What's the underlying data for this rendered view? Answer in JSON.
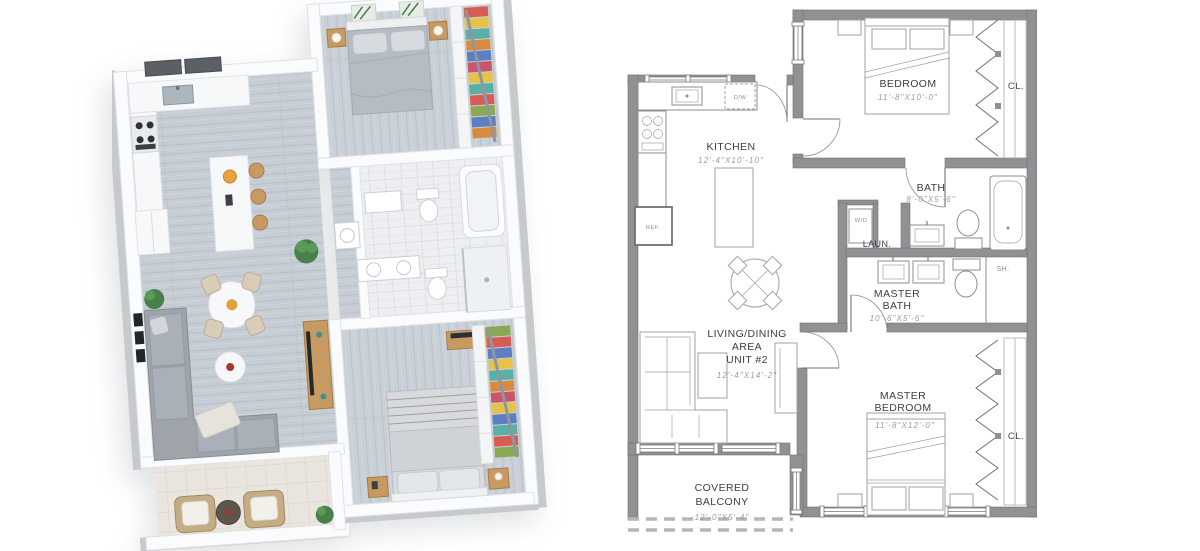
{
  "plan2d": {
    "kitchen": {
      "name": "KITCHEN",
      "dims": "12'-4\"X10'-10\""
    },
    "bedroom": {
      "name": "BEDROOM",
      "dims": "11'-8\"X10'-0\""
    },
    "closet_top": {
      "name": "CL."
    },
    "bath": {
      "name": "BATH",
      "dims": "8'-0\"X5'-6\""
    },
    "laundry": {
      "name": "LAUN.",
      "appliance": "W/D"
    },
    "master_bath": {
      "line1": "MASTER",
      "line2": "BATH",
      "dims": "10'-6\"X5'-6\""
    },
    "shower": {
      "name": "SH."
    },
    "living": {
      "line1": "LIVING/DINING",
      "line2": "AREA",
      "line3": "UNIT #2",
      "dims": "12'-4\"X14'-2\""
    },
    "master_bedroom": {
      "line1": "MASTER",
      "line2": "BEDROOM",
      "dims": "11'-8\"X12'-0\""
    },
    "closet_bottom": {
      "name": "CL."
    },
    "balcony": {
      "line1": "COVERED",
      "line2": "BALCONY",
      "dims": "12'-0\"X5'-4\""
    },
    "fridge": {
      "name": "REF."
    },
    "dishwasher": {
      "name": "D/W"
    }
  },
  "colors": {
    "wall_gray": "#8f9193",
    "room_text": "#3d3d3d",
    "dim_text": "#9b9b9d",
    "floor_wood": "#c7cdd4",
    "wood_accent": "#c79a62",
    "closet_red": "#d85c55",
    "closet_yellow": "#e6c348",
    "closet_teal": "#58b0a6",
    "closet_blue": "#5d7fc1"
  }
}
